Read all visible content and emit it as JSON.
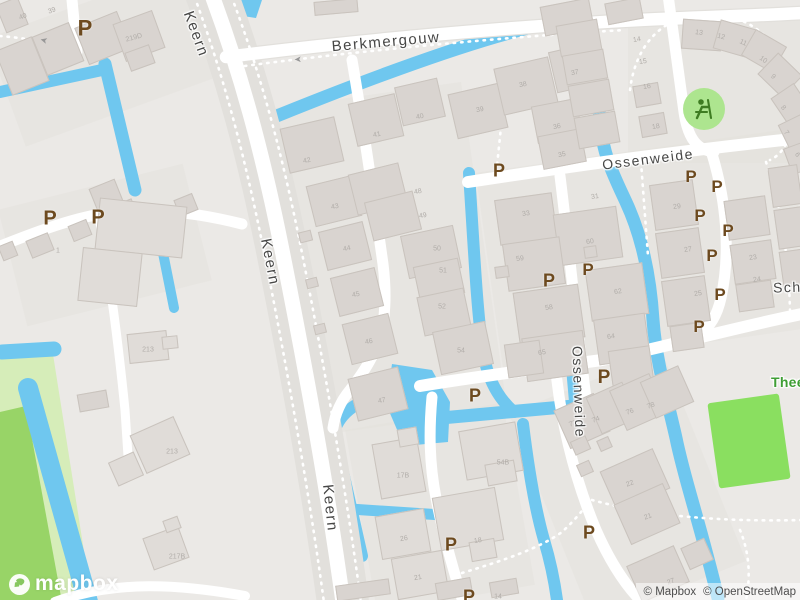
{
  "map": {
    "colors": {
      "land": "#ebe9e6",
      "block": "#e4e1dd",
      "water": "#6fc7ef",
      "road": "#ffffff",
      "casing": "#e2e0dc",
      "bldg": "#d9d4d0",
      "bldgb": "#c9c3bd",
      "park": "#d6edb9",
      "park2": "#98d467",
      "field": "#8adf60",
      "playground": "#ade58f",
      "playicon": "#3e7c22",
      "pcolor": "#6d4a1f",
      "street": "#474746",
      "hn": "#b1ada9",
      "greenlabel": "#3f9e35",
      "attr": "#4e4e4e"
    },
    "logo_text": "mapbox",
    "attribution": {
      "mapbox": "© Mapbox",
      "osm": "© OpenStreetMap"
    },
    "icons": {
      "playground": "playground-figure",
      "logo": "mapbox-star"
    },
    "street_labels": [
      {
        "text": "Berkmergouw",
        "x": 386,
        "y": 42,
        "rot": -5,
        "size": 15
      },
      {
        "text": "Keern",
        "x": 196,
        "y": 34,
        "rot": 70,
        "size": 15
      },
      {
        "text": "Keern",
        "x": 270,
        "y": 262,
        "rot": 79,
        "size": 15
      },
      {
        "text": "Keern",
        "x": 330,
        "y": 508,
        "rot": 84,
        "size": 15
      },
      {
        "text": "Ossenweide",
        "x": 648,
        "y": 159,
        "rot": -7,
        "size": 14
      },
      {
        "text": "Ossenweide",
        "x": 579,
        "y": 392,
        "rot": 88,
        "size": 14
      },
      {
        "text": "Scho",
        "x": 792,
        "y": 287,
        "rot": -2,
        "size": 14
      },
      {
        "text": "Theel",
        "x": 790,
        "y": 382,
        "rot": 0,
        "size": 14,
        "color": "green"
      }
    ],
    "parking_symbols": [
      {
        "x": 85,
        "y": 29,
        "s": 22
      },
      {
        "x": 50,
        "y": 219,
        "s": 20
      },
      {
        "x": 98,
        "y": 218,
        "s": 20
      },
      {
        "x": 499,
        "y": 171,
        "s": 18
      },
      {
        "x": 691,
        "y": 177,
        "s": 17
      },
      {
        "x": 717,
        "y": 187,
        "s": 17
      },
      {
        "x": 700,
        "y": 216,
        "s": 17
      },
      {
        "x": 728,
        "y": 231,
        "s": 17
      },
      {
        "x": 712,
        "y": 256,
        "s": 17
      },
      {
        "x": 720,
        "y": 295,
        "s": 17
      },
      {
        "x": 699,
        "y": 327,
        "s": 17
      },
      {
        "x": 549,
        "y": 281,
        "s": 18
      },
      {
        "x": 588,
        "y": 270,
        "s": 17
      },
      {
        "x": 604,
        "y": 378,
        "s": 19
      },
      {
        "x": 475,
        "y": 396,
        "s": 18
      },
      {
        "x": 451,
        "y": 545,
        "s": 18
      },
      {
        "x": 589,
        "y": 533,
        "s": 18
      },
      {
        "x": 469,
        "y": 597,
        "s": 18
      }
    ],
    "oneway_arrows": [
      {
        "g": "➤",
        "x": 44,
        "y": 40,
        "rot": 195
      },
      {
        "g": "➤",
        "x": 298,
        "y": 59,
        "rot": 178
      }
    ],
    "house_numbers": [
      [
        "40",
        23,
        17,
        -20
      ],
      [
        "39",
        52,
        11,
        -20
      ],
      [
        "219D",
        134,
        38,
        -15
      ],
      [
        "1",
        58,
        251,
        0
      ],
      [
        "213",
        148,
        350,
        0
      ],
      [
        "213",
        172,
        452,
        0
      ],
      [
        "217B",
        177,
        557,
        0
      ],
      [
        "42",
        307,
        161,
        -12
      ],
      [
        "43",
        335,
        207,
        -12
      ],
      [
        "44",
        347,
        249,
        -12
      ],
      [
        "45",
        356,
        295,
        -12
      ],
      [
        "46",
        369,
        342,
        -12
      ],
      [
        "47",
        382,
        401,
        -12
      ],
      [
        "48",
        418,
        192,
        -12
      ],
      [
        "49",
        423,
        216,
        -12
      ],
      [
        "50",
        437,
        249,
        0
      ],
      [
        "51",
        443,
        271,
        0
      ],
      [
        "52",
        442,
        307,
        0
      ],
      [
        "54",
        461,
        351,
        0
      ],
      [
        "41",
        377,
        135,
        -12
      ],
      [
        "40",
        420,
        117,
        -12
      ],
      [
        "39",
        480,
        110,
        -12
      ],
      [
        "38",
        523,
        85,
        -12
      ],
      [
        "37",
        575,
        73,
        -12
      ],
      [
        "36",
        557,
        127,
        -11
      ],
      [
        "35",
        562,
        155,
        -11
      ],
      [
        "14",
        637,
        40,
        -10
      ],
      [
        "15",
        643,
        62,
        -10
      ],
      [
        "16",
        647,
        87,
        -10
      ],
      [
        "18",
        656,
        127,
        -10
      ],
      [
        "13",
        699,
        33,
        8
      ],
      [
        "12",
        721,
        37,
        15
      ],
      [
        "11",
        743,
        43,
        25
      ],
      [
        "10",
        763,
        60,
        35
      ],
      [
        "9",
        773,
        77,
        40
      ],
      [
        "8",
        783,
        108,
        50
      ],
      [
        "7",
        786,
        133,
        55
      ],
      [
        "6",
        797,
        155,
        60
      ],
      [
        "33",
        526,
        214,
        -8
      ],
      [
        "31",
        595,
        197,
        -8
      ],
      [
        "59",
        520,
        259,
        -8
      ],
      [
        "60",
        590,
        242,
        -8
      ],
      [
        "62",
        618,
        292,
        -8
      ],
      [
        "58",
        549,
        308,
        -8
      ],
      [
        "64",
        611,
        337,
        -8
      ],
      [
        "65",
        542,
        353,
        -8
      ],
      [
        "29",
        677,
        207,
        -8
      ],
      [
        "27",
        688,
        250,
        -8
      ],
      [
        "25",
        698,
        294,
        -8
      ],
      [
        "23",
        753,
        258,
        -8
      ],
      [
        "24",
        757,
        280,
        -8
      ],
      [
        "72",
        573,
        424,
        -20
      ],
      [
        "74",
        596,
        420,
        -20
      ],
      [
        "76",
        630,
        412,
        -20
      ],
      [
        "78",
        651,
        406,
        -20
      ],
      [
        "22",
        630,
        484,
        -20
      ],
      [
        "21",
        648,
        517,
        -20
      ],
      [
        "17B",
        403,
        476,
        0
      ],
      [
        "54B",
        503,
        463,
        0
      ],
      [
        "26",
        404,
        539,
        -10
      ],
      [
        "18",
        478,
        541,
        -10
      ],
      [
        "21",
        418,
        578,
        -10
      ],
      [
        "27",
        671,
        582,
        -20
      ],
      [
        "14",
        498,
        597,
        0
      ]
    ],
    "blocks": [
      [
        275,
        95,
        210,
        330,
        -8
      ],
      [
        488,
        150,
        315,
        200,
        -8
      ],
      [
        0,
        0,
        205,
        115,
        -20
      ],
      [
        545,
        375,
        165,
        225,
        -22
      ],
      [
        360,
        415,
        160,
        185,
        -10
      ],
      [
        628,
        15,
        175,
        148,
        0
      ],
      [
        10,
        185,
        190,
        120,
        -14
      ]
    ],
    "buildings": [
      [
        0,
        0,
        24,
        30,
        -22
      ],
      [
        2,
        42,
        40,
        48,
        -22
      ],
      [
        38,
        28,
        40,
        42,
        -22
      ],
      [
        80,
        18,
        46,
        40,
        -22
      ],
      [
        118,
        16,
        42,
        40,
        -20
      ],
      [
        127,
        48,
        26,
        20,
        -20
      ],
      [
        92,
        183,
        28,
        24,
        -22
      ],
      [
        112,
        202,
        24,
        20,
        -22
      ],
      [
        70,
        222,
        20,
        17,
        -22
      ],
      [
        28,
        236,
        24,
        19,
        -22
      ],
      [
        0,
        243,
        16,
        16,
        -22
      ],
      [
        176,
        196,
        20,
        18,
        -22
      ],
      [
        314,
        0,
        44,
        14,
        -5
      ],
      [
        97,
        202,
        88,
        52,
        6,
        1
      ],
      [
        80,
        250,
        60,
        54,
        6,
        1
      ],
      [
        128,
        332,
        40,
        30,
        -6,
        1
      ],
      [
        162,
        336,
        16,
        13,
        -6,
        1
      ],
      [
        136,
        424,
        48,
        42,
        -24,
        1
      ],
      [
        112,
        456,
        28,
        26,
        -24,
        1
      ],
      [
        147,
        531,
        38,
        34,
        -20,
        1
      ],
      [
        164,
        518,
        16,
        13,
        -20,
        1
      ],
      [
        78,
        392,
        30,
        18,
        -10
      ],
      [
        284,
        122,
        56,
        46,
        -13
      ],
      [
        352,
        98,
        48,
        44,
        -13
      ],
      [
        398,
        82,
        44,
        40,
        -13
      ],
      [
        452,
        88,
        52,
        46,
        -13
      ],
      [
        310,
        180,
        48,
        42,
        -14
      ],
      [
        322,
        226,
        46,
        40,
        -14
      ],
      [
        334,
        272,
        46,
        40,
        -14
      ],
      [
        346,
        318,
        48,
        42,
        -14
      ],
      [
        352,
        372,
        52,
        44,
        -14
      ],
      [
        299,
        231,
        13,
        11,
        -14
      ],
      [
        306,
        278,
        12,
        10,
        -14
      ],
      [
        314,
        324,
        12,
        10,
        -14
      ],
      [
        352,
        168,
        52,
        42,
        -14
      ],
      [
        368,
        196,
        50,
        40,
        -14
      ],
      [
        404,
        230,
        54,
        44,
        -12
      ],
      [
        416,
        262,
        46,
        36,
        -12
      ],
      [
        420,
        292,
        48,
        40,
        -12
      ],
      [
        436,
        326,
        54,
        44,
        -12
      ],
      [
        498,
        62,
        56,
        48,
        -13
      ],
      [
        552,
        46,
        52,
        42,
        -13
      ],
      [
        534,
        102,
        46,
        38,
        -11
      ],
      [
        540,
        132,
        44,
        34,
        -11
      ],
      [
        542,
        2,
        50,
        30,
        -11
      ],
      [
        606,
        0,
        36,
        22,
        -11
      ],
      [
        558,
        22,
        42,
        32,
        -10
      ],
      [
        564,
        52,
        42,
        30,
        -10
      ],
      [
        570,
        82,
        42,
        32,
        -10
      ],
      [
        576,
        114,
        42,
        32,
        -10
      ],
      [
        634,
        84,
        26,
        22,
        -10
      ],
      [
        640,
        114,
        26,
        22,
        -10
      ],
      [
        682,
        20,
        40,
        30,
        4
      ],
      [
        716,
        24,
        38,
        30,
        16
      ],
      [
        746,
        36,
        36,
        30,
        30
      ],
      [
        763,
        60,
        34,
        30,
        44
      ],
      [
        775,
        90,
        32,
        28,
        56
      ],
      [
        781,
        120,
        30,
        26,
        64
      ],
      [
        785,
        146,
        28,
        24,
        70
      ],
      [
        497,
        196,
        58,
        46,
        -8
      ],
      [
        556,
        210,
        64,
        52,
        -8
      ],
      [
        505,
        240,
        58,
        48,
        -8
      ],
      [
        516,
        288,
        66,
        54,
        -8
      ],
      [
        588,
        266,
        58,
        52,
        -8
      ],
      [
        524,
        334,
        62,
        44,
        -8
      ],
      [
        596,
        316,
        52,
        46,
        -8
      ],
      [
        506,
        342,
        36,
        34,
        -8
      ],
      [
        610,
        348,
        42,
        36,
        -8
      ],
      [
        495,
        266,
        14,
        12,
        -8
      ],
      [
        584,
        246,
        13,
        12,
        -8
      ],
      [
        652,
        182,
        44,
        46,
        -8
      ],
      [
        658,
        230,
        44,
        46,
        -8
      ],
      [
        664,
        278,
        44,
        46,
        -8
      ],
      [
        671,
        324,
        32,
        26,
        -8
      ],
      [
        726,
        198,
        42,
        40,
        -8
      ],
      [
        732,
        242,
        42,
        40,
        -8
      ],
      [
        737,
        282,
        36,
        28,
        -8
      ],
      [
        770,
        166,
        30,
        40,
        -8
      ],
      [
        776,
        208,
        28,
        40,
        -8
      ],
      [
        781,
        250,
        26,
        36,
        -8
      ],
      [
        560,
        400,
        44,
        42,
        -24
      ],
      [
        592,
        388,
        40,
        40,
        -24
      ],
      [
        616,
        380,
        44,
        44,
        -24
      ],
      [
        646,
        372,
        42,
        40,
        -24
      ],
      [
        606,
        458,
        58,
        44,
        -24
      ],
      [
        620,
        492,
        54,
        44,
        -24
      ],
      [
        572,
        438,
        17,
        15,
        -24
      ],
      [
        578,
        462,
        14,
        13,
        -24
      ],
      [
        598,
        438,
        13,
        12,
        -24
      ],
      [
        632,
        554,
        52,
        40,
        -24
      ],
      [
        684,
        542,
        26,
        24,
        -24
      ],
      [
        376,
        440,
        46,
        56,
        -10,
        1
      ],
      [
        398,
        428,
        20,
        18,
        -10,
        1
      ],
      [
        462,
        426,
        58,
        50,
        -10,
        1
      ],
      [
        486,
        462,
        30,
        22,
        -10,
        1
      ],
      [
        378,
        512,
        50,
        44,
        -10,
        1
      ],
      [
        436,
        492,
        64,
        54,
        -10,
        1
      ],
      [
        470,
        540,
        26,
        20,
        -10,
        1
      ],
      [
        394,
        554,
        52,
        42,
        -10,
        1
      ],
      [
        436,
        580,
        36,
        18,
        -10
      ],
      [
        490,
        580,
        28,
        16,
        -10
      ],
      [
        336,
        582,
        54,
        16,
        -8
      ]
    ]
  }
}
